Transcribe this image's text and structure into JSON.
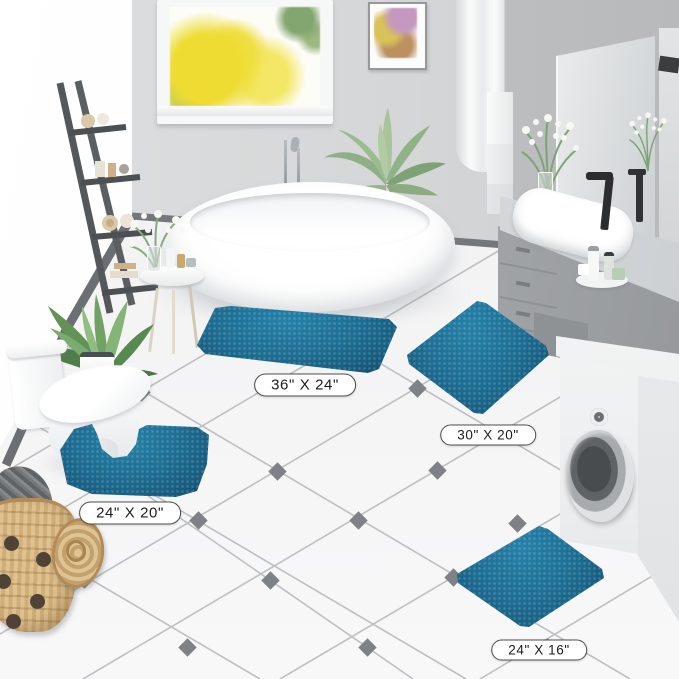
{
  "page": {
    "type": "product-photo",
    "setting": "bright modern bathroom"
  },
  "size_labels": {
    "rug_large": "36\" X 24\"",
    "rug_medium": "30\" X 20\"",
    "rug_contour": "24\" X 20\"",
    "rug_small": "24\" X 16\""
  },
  "colors": {
    "rug_teal": "#1e6e93",
    "rug_teal_highlight": "#2581a8",
    "rug_teal_shadow": "#114a66",
    "wall_gray": "#d4d6d7",
    "floor_white": "#f2f2f3",
    "tile_accent_diamond": "#7e8286",
    "label_border": "#4c4c4c",
    "basket_tan": "#d5b483"
  },
  "scene_objects": [
    "freestanding white bathtub",
    "floor-standing chrome tub faucet",
    "window with yellow autumn trees",
    "framed botanical watercolor art",
    "sheer white curtain",
    "dark gray ladder shelf with rolled towels",
    "potted palm plant",
    "potted leafy green plant",
    "round side table with vase and toiletries",
    "white toilet",
    "gray vanity with white sink, black faucet and flower vase",
    "wall mirror reflecting flowers and faucet",
    "white washing machine with round door",
    "woven laundry basket with lid and gray cloth",
    "teal chenille bath rug 36x24",
    "teal chenille bath rug 30x20",
    "teal contour bath rug 24x20",
    "teal chenille bath rug 24x16",
    "white tile floor with diamond accents"
  ]
}
